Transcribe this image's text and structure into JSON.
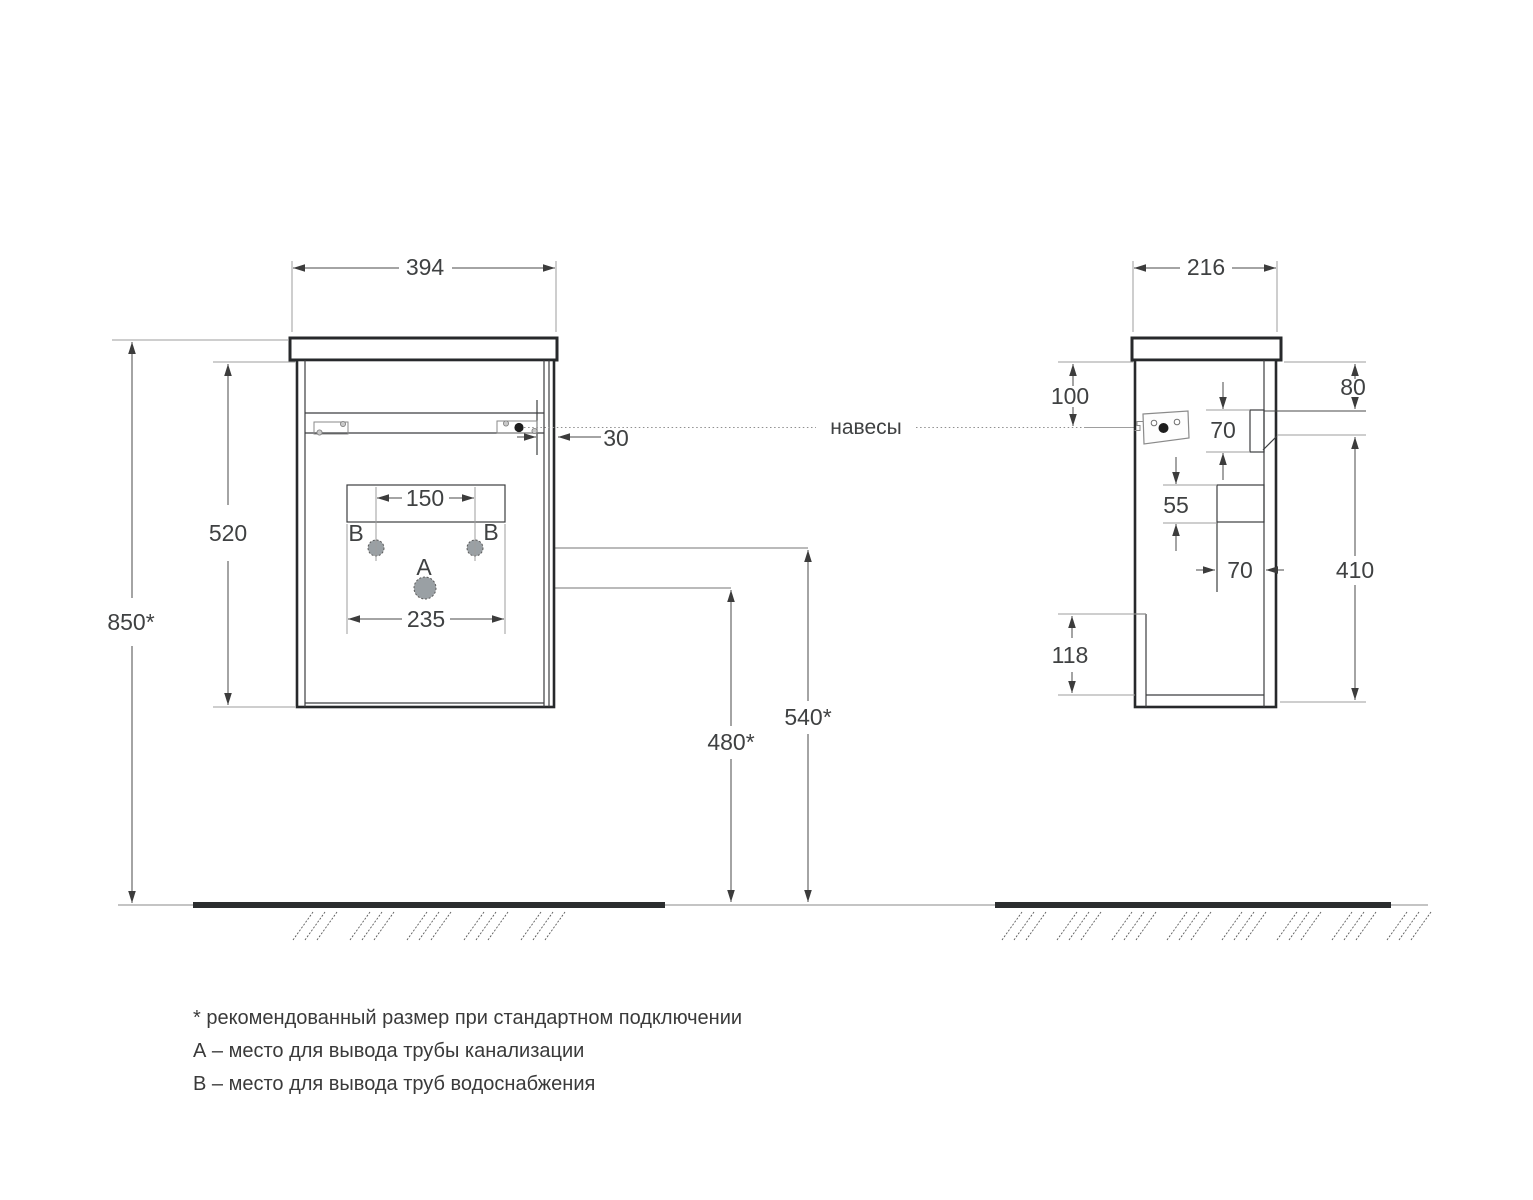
{
  "front_view": {
    "width": "394",
    "total_height": "850*",
    "body_height": "520",
    "hanger_offset": "30",
    "b_holes_spacing": "150",
    "cutout_width": "235",
    "drain_height": "480*",
    "supply_height": "540*",
    "label_a": "A",
    "label_b_left": "B",
    "label_b_right": "B"
  },
  "side_view": {
    "depth": "216",
    "hanger_from_top": "100",
    "top_to_bracket": "80",
    "bracket_height": "70",
    "back_cutout_height": "55",
    "back_cutout_depth": "70",
    "bracket_to_bottom": "410",
    "bottom_recess": "118"
  },
  "hangers_label": "навесы",
  "footnotes": [
    "* рекомендованный размер при стандартном подключении",
    "А – место для вывода трубы канализации",
    "В – место для вывода труб водоснабжения"
  ]
}
